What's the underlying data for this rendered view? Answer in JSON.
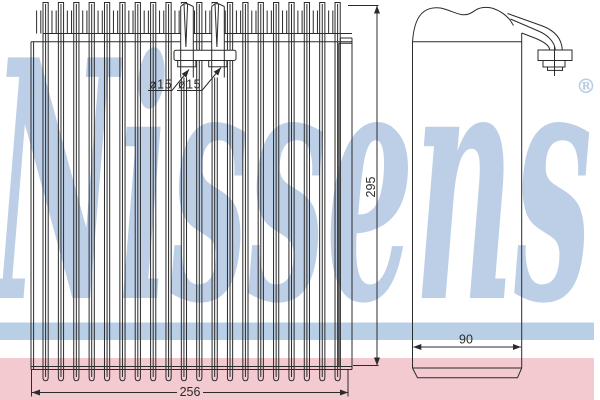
{
  "watermark": {
    "brand": "Nissens",
    "registered_mark": "®"
  },
  "front_view": {
    "pipe_labels": [
      "ø15",
      "ø15"
    ],
    "width_dim": "256",
    "height_dim": "295"
  },
  "side_view": {
    "depth_dim": "90"
  },
  "colors": {
    "line": "#2b2b2b",
    "watermark_blue": "#a9c2e0",
    "stripe_blue": "#b9cfe6",
    "band_pink": "#f2cad0",
    "background": "#ffffff"
  }
}
